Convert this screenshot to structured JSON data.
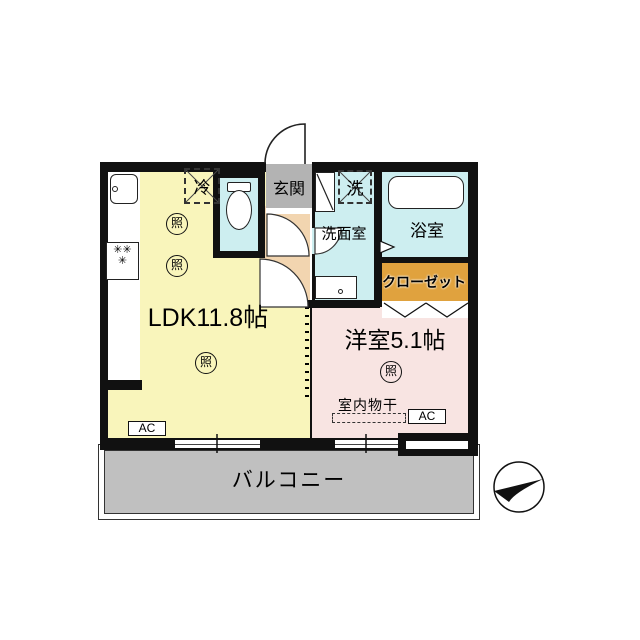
{
  "plan": {
    "type": "apartment-floor-plan",
    "rooms": {
      "ldk": "LDK11.8帖",
      "western_room": "洋室5.1帖",
      "entrance": "玄関",
      "washroom": "洗面室",
      "bathroom": "浴室",
      "closet": "クローゼット",
      "balcony": "バルコニー"
    },
    "fixtures": {
      "fridge": "冷",
      "washer": "洗",
      "light": "照",
      "ac": "AC",
      "indoor_drying": "室内物干",
      "burner": "✳"
    },
    "colors": {
      "ldk_floor": "#f9f5bb",
      "western_room_floor": "#f8e4e2",
      "wet_area_floor": "#cdeef0",
      "entrance_floor": "#b3b3b3",
      "hall_floor": "#f2d5b0",
      "closet_fill": "#e0a23e",
      "balcony_fill": "#c0c0c0",
      "wall": "#111111"
    },
    "compass": "north-arrow-pointing-upper-right"
  }
}
